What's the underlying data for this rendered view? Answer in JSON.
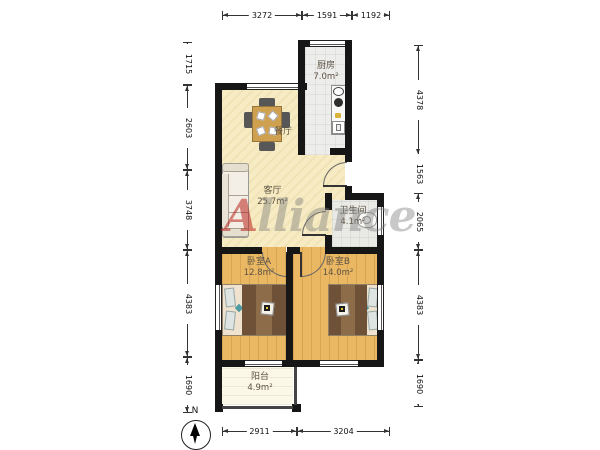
{
  "plan": {
    "rooms": {
      "kitchen": {
        "name": "厨房",
        "area": "7.0m²"
      },
      "dining": {
        "name": "餐厅"
      },
      "living": {
        "name": "客厅",
        "area": "25.7m²"
      },
      "bathroom": {
        "name": "卫生间",
        "area": "4.1m²"
      },
      "bedroom_a": {
        "name": "卧室A",
        "area": "12.8m²"
      },
      "bedroom_b": {
        "name": "卧室B",
        "area": "14.0m²"
      },
      "balcony": {
        "name": "阳台",
        "area": "4.9m²"
      }
    },
    "dimensions": {
      "top": [
        "3272",
        "1591",
        "1192"
      ],
      "left": [
        "1715",
        "2603",
        "3748",
        "4383",
        "1690"
      ],
      "right": [
        "4378",
        "1563",
        "2065",
        "4383",
        "1690"
      ],
      "bottom": [
        "2911",
        "3204"
      ]
    },
    "compass": {
      "label": "N"
    },
    "watermark": {
      "first_letter": "A",
      "rest": "lliance"
    },
    "colors": {
      "wall": "#161616",
      "floor_living": "#f6ebc3",
      "floor_wood": "#eab763",
      "floor_tile": "#ededeb",
      "floor_balcony": "#fbf8e8",
      "watermark_red": "#ba201e",
      "watermark_gray": "#7d7d7d"
    }
  }
}
